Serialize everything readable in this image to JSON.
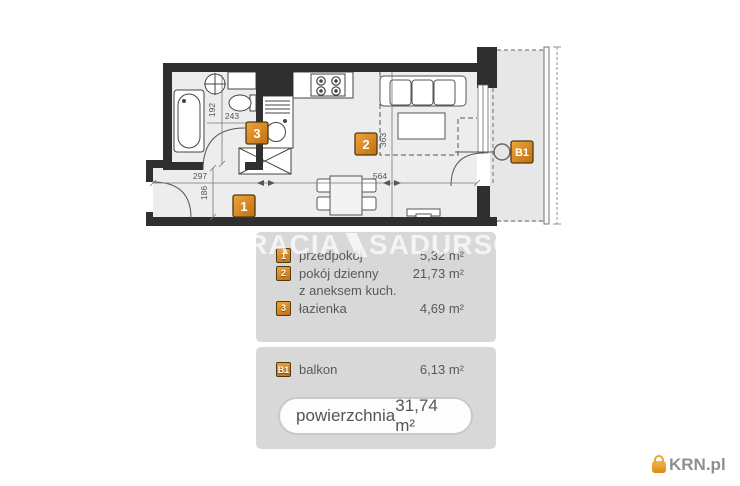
{
  "plan": {
    "markers": {
      "hall": "1",
      "living": "2",
      "bath": "3",
      "balcony": "B1"
    },
    "dimensions": {
      "bath_width": "243",
      "bath_height": "192",
      "hall_width": "297",
      "hall_height": "186",
      "living_width": "564",
      "living_height": "363"
    }
  },
  "watermark": {
    "part1": "BRACIA",
    "part2": "SADURSCY"
  },
  "legend": {
    "rows": [
      {
        "marker": "1",
        "label": "przedpokój",
        "area": "5,32 m²"
      },
      {
        "marker": "2",
        "label": "pokój dzienny",
        "area": "21,73 m²"
      },
      {
        "marker": "",
        "label": "z aneksem kuch.",
        "area": ""
      },
      {
        "marker": "3",
        "label": "łazienka",
        "area": "4,69 m²"
      }
    ],
    "balcony_row": {
      "marker": "B1",
      "label": "balkon",
      "area": "6,13 m²"
    },
    "total": {
      "label": "powierzchnia",
      "value": "31,74 m²"
    }
  },
  "branding": {
    "site": "KRN.pl"
  },
  "colors": {
    "marker_orange": "#d98920",
    "wall": "#2f2f2f",
    "floor": "#ededed",
    "legend_bg": "#d8d8d8"
  }
}
